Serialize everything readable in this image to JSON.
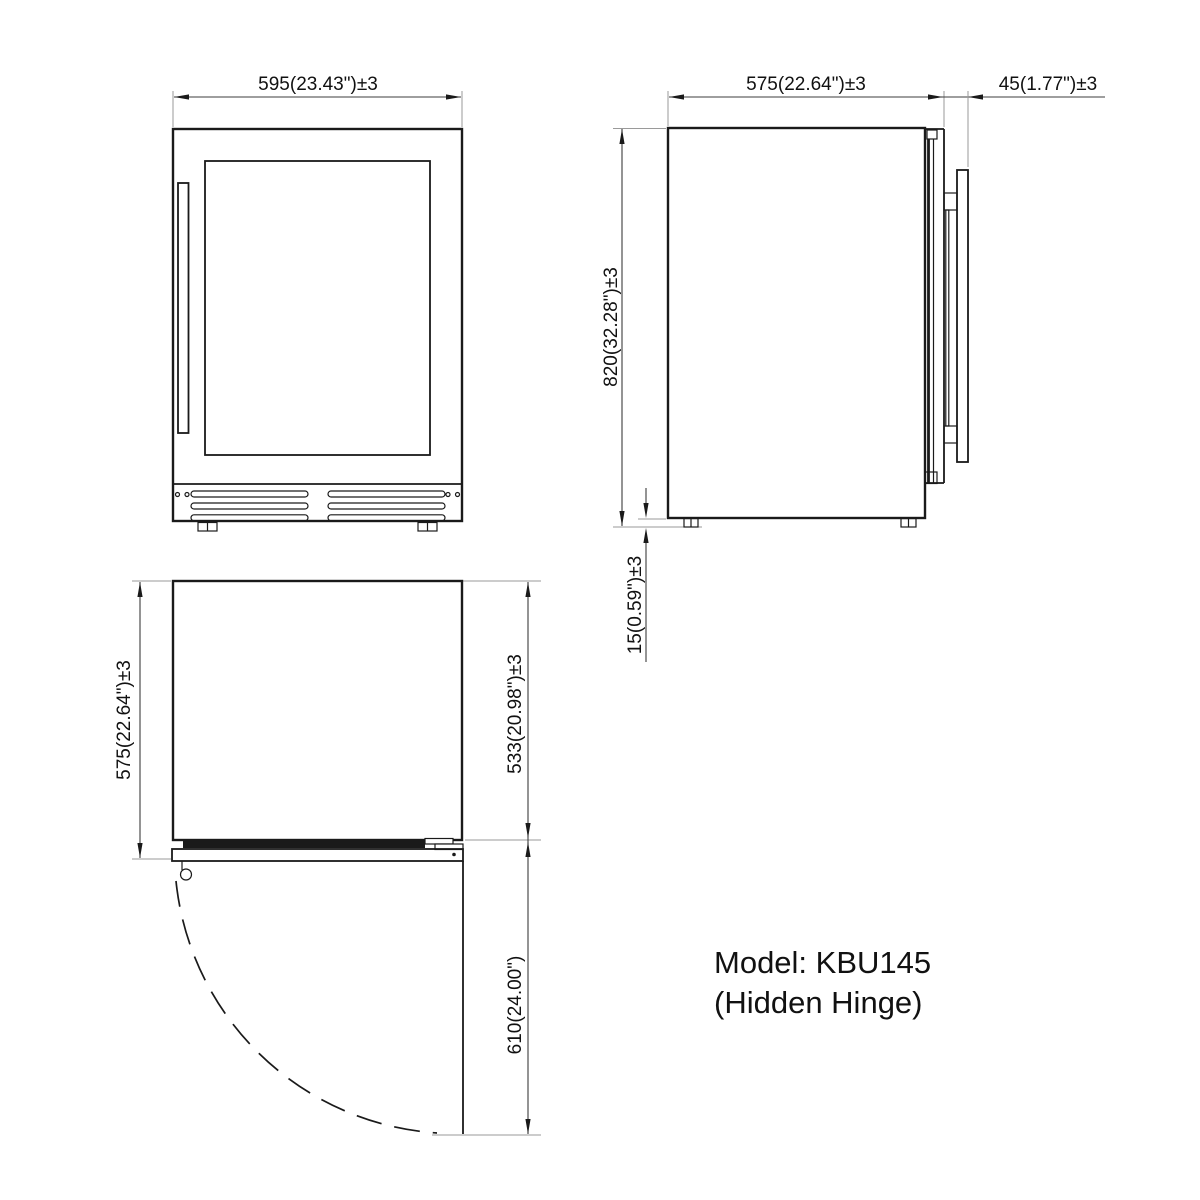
{
  "title": {
    "line1": "Model: KBU145",
    "line2": "(Hidden Hinge)"
  },
  "views": {
    "front": {
      "width_dim": "595(23.43\")±3"
    },
    "side": {
      "depth_dim": "575(22.64\")±3",
      "handle_dim": "45(1.77\")±3",
      "height_dim": "820(32.28\")±3",
      "leg_dim": "15(0.59\")±3"
    },
    "top": {
      "depth_with_door_dim": "575(22.64\")±3",
      "body_depth_dim": "533(20.98\")±3",
      "door_swing_dim": "610(24.00\")"
    }
  },
  "colors": {
    "line": "#1a1a1a",
    "dimension": "#3c3c3c",
    "extension": "#9a9a9a",
    "text": "#111111",
    "background": "#ffffff"
  }
}
